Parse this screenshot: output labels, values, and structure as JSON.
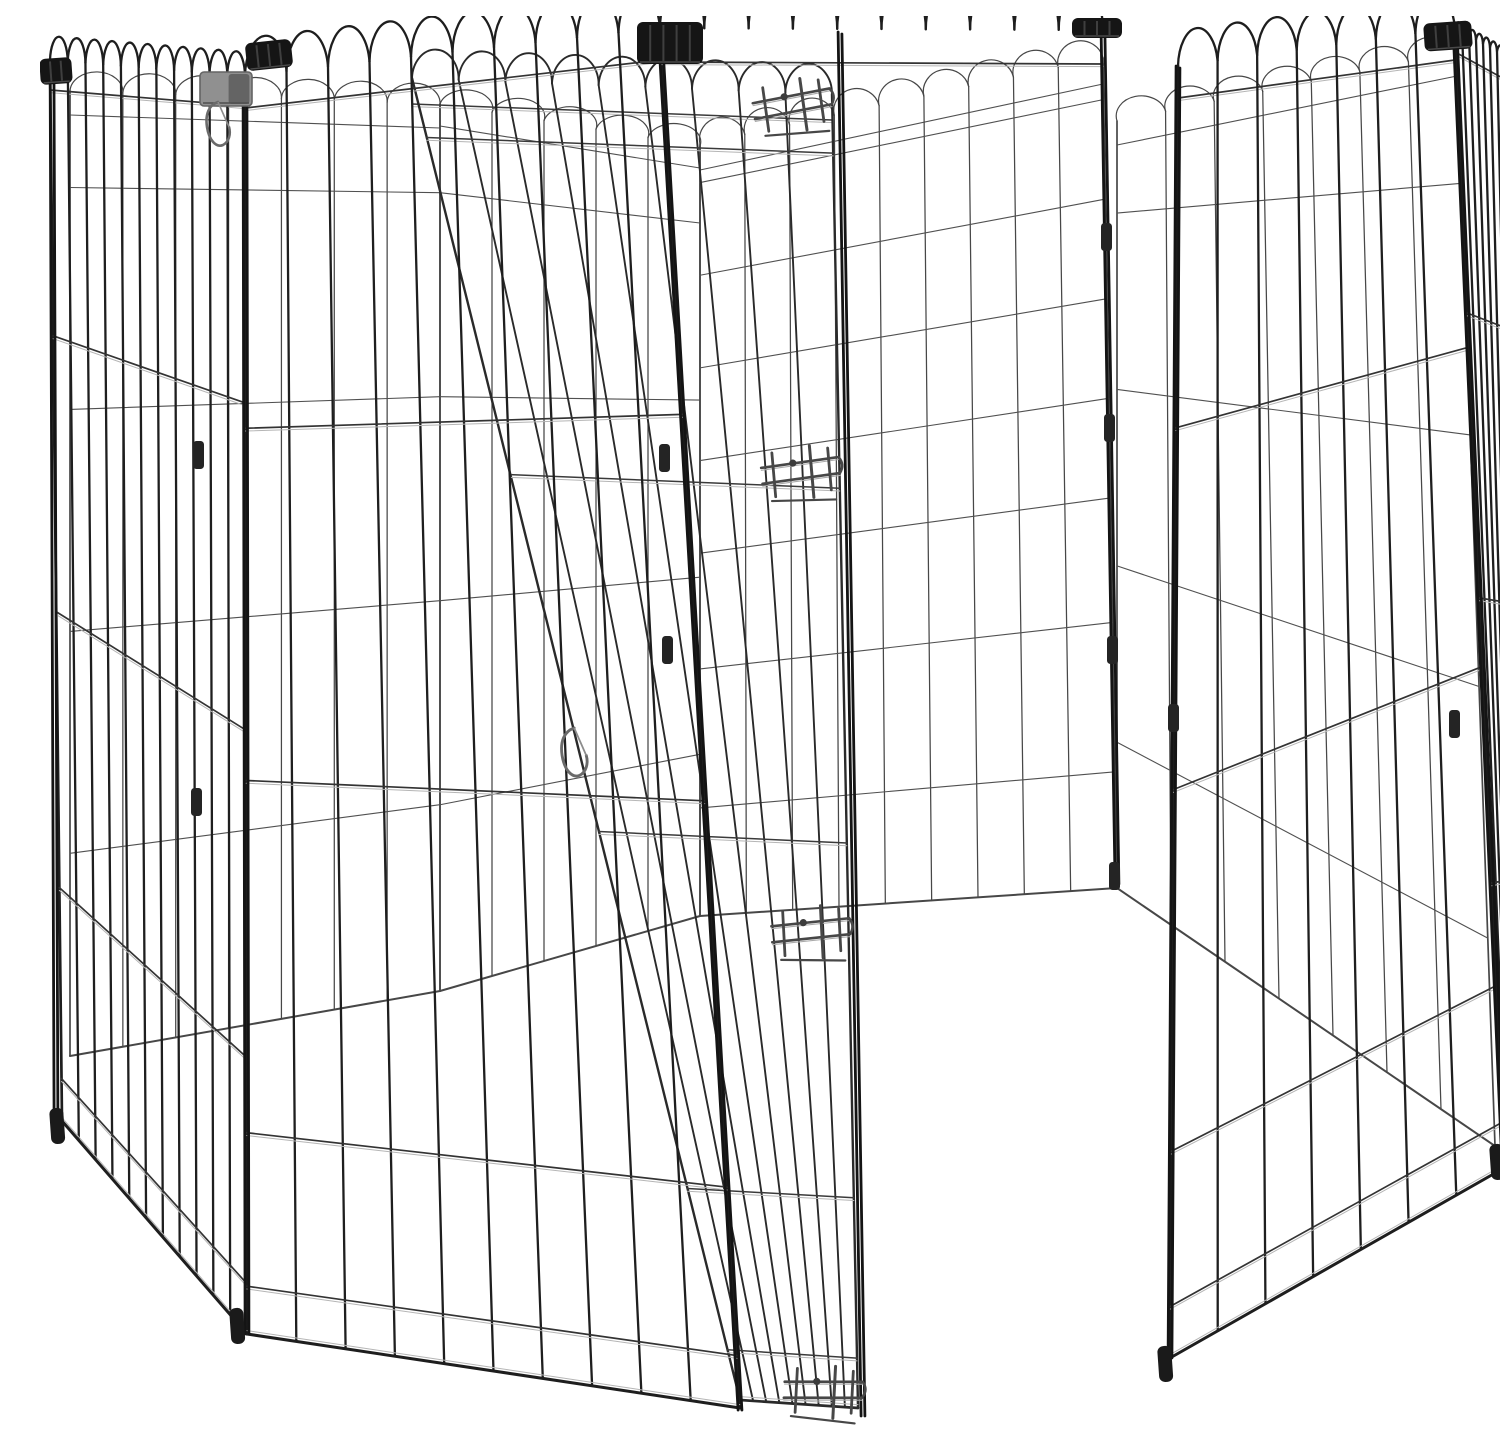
{
  "scene": {
    "label": "Octagonal black metal wire pet exercise pen with open walk-through door",
    "background": "#ffffff",
    "width": 1500,
    "height": 1412
  },
  "colors": {
    "wire_front": "#1e1e1e",
    "wire_front_h": "#333333",
    "wire_mid": "#2a2a2a",
    "wire_mid_h": "#3a3a3a",
    "wire_back": "#474747",
    "wire_back_h": "#505050",
    "wire_highlight": "#b5b5b5",
    "post": "#141414",
    "clip_black": "#151515",
    "clip_rib": "#3f3f3f",
    "clip_grey": "#909090",
    "clip_grey_dark": "#646464",
    "metal": "#474747",
    "metal_highlight": "#aaaaaa",
    "foot": "#1a1a1a"
  },
  "strokes": {
    "front_v": 2.3,
    "front_h": 1.7,
    "front_loop": 2.3,
    "front_edge": 2.7,
    "mid_v": 1.9,
    "mid_h": 1.5,
    "mid_loop": 1.9,
    "mid_edge": 2.4,
    "back_v": 1.25,
    "back_h": 1.1,
    "back_loop": 1.2,
    "back_edge": 1.7,
    "highlight": 1.0,
    "post": 2.8
  },
  "panels": [
    {
      "name": "panel-back-left-far",
      "layer": "back",
      "quad": [
        [
          30,
          75
        ],
        [
          400,
          88
        ],
        [
          400,
          975
        ],
        [
          30,
          1040
        ]
      ],
      "nV": 8,
      "loopH": 20,
      "topRail": 24,
      "hFracs": [
        0.1,
        0.33,
        0.56,
        0.79
      ],
      "bottom": true
    },
    {
      "name": "panel-back-center-far",
      "layer": "back",
      "quad": [
        [
          400,
          88
        ],
        [
          660,
          130
        ],
        [
          660,
          900
        ],
        [
          400,
          975
        ]
      ],
      "nV": 6,
      "loopH": 18,
      "topRail": 22,
      "hFracs": [
        0.1,
        0.33,
        0.56,
        0.79
      ],
      "bottom": true
    },
    {
      "name": "panel-back-right-inner",
      "layer": "back",
      "quad": [
        [
          660,
          128
        ],
        [
          1063,
          42
        ],
        [
          1077,
          872
        ],
        [
          660,
          900
        ]
      ],
      "nV": 10,
      "loopH": 22,
      "topRail": 26,
      "hFracs": [
        0.05,
        0.17,
        0.29,
        0.41,
        0.53,
        0.68,
        0.86
      ],
      "bottom": true
    },
    {
      "name": "panel-back-right-side",
      "layer": "back",
      "quad": [
        [
          1077,
          105
        ],
        [
          1417,
          36
        ],
        [
          1455,
          1130
        ],
        [
          1077,
          872
        ]
      ],
      "nV": 8,
      "loopH": 20,
      "topRail": 24,
      "hFracs": [
        0.12,
        0.35,
        0.58,
        0.81
      ],
      "bottom": true
    },
    {
      "name": "panel-door-open",
      "layer": "mid",
      "quad": [
        [
          372,
          62
        ],
        [
          792,
          78
        ],
        [
          818,
          1392
        ],
        [
          700,
          1384
        ]
      ],
      "nV": 10,
      "loopH": 30,
      "topRail": 26,
      "hFracs": [
        0.045,
        0.3,
        0.57,
        0.84,
        0.962
      ],
      "bottom": true
    },
    {
      "name": "panel-side-left",
      "layer": "front",
      "quad": [
        [
          10,
          44
        ],
        [
          205,
          60
        ],
        [
          207,
          1318
        ],
        [
          22,
          1105
        ]
      ],
      "nV": 12,
      "loopH": 26,
      "topRail": 30,
      "hFracs": [
        0.26,
        0.52,
        0.78,
        0.96
      ],
      "bottom": true
    },
    {
      "name": "panel-front-left",
      "layer": "front",
      "quad": [
        [
          205,
          60
        ],
        [
          620,
          12
        ],
        [
          700,
          1392
        ],
        [
          207,
          1318
        ]
      ],
      "nV": 11,
      "loopH": 42,
      "topRail": 32,
      "hFracs": [
        0.28,
        0.56,
        0.84,
        0.962
      ],
      "bottom": true
    },
    {
      "name": "top-rim-doorway",
      "layer": "front",
      "quad": [
        [
          620,
          12
        ],
        [
          1063,
          14
        ],
        [
          1063,
          14
        ],
        [
          620,
          12
        ]
      ],
      "nV": 11,
      "loopH": 44,
      "topRail": 34,
      "hFracs": [],
      "bottom": false,
      "loopsOnly": true
    },
    {
      "name": "panel-front-right",
      "layer": "front",
      "quad": [
        [
          1138,
          50
        ],
        [
          1415,
          12
        ],
        [
          1464,
          1152
        ],
        [
          1130,
          1342
        ]
      ],
      "nV": 8,
      "loopH": 40,
      "topRail": 32,
      "hFracs": [
        0.28,
        0.56,
        0.84,
        0.96
      ],
      "bottom": true
    },
    {
      "name": "panel-side-right",
      "layer": "front",
      "quad": [
        [
          1415,
          12
        ],
        [
          1499,
          58
        ],
        [
          1499,
          1125
        ],
        [
          1464,
          1152
        ]
      ],
      "nV": 13,
      "loopH": 14,
      "topRail": 24,
      "hFracs": [
        0.25,
        0.5,
        0.75,
        0.96
      ],
      "bottom": true
    }
  ],
  "posts": [
    {
      "name": "post-left-corner",
      "x1": 12,
      "y1": 44,
      "x2": 16,
      "y2": 1102
    },
    {
      "name": "post-front-left",
      "x1": 205,
      "y1": 60,
      "x2": 207,
      "y2": 1318
    },
    {
      "name": "post-door-left",
      "x1": 620,
      "y1": 12,
      "x2": 700,
      "y2": 1394
    },
    {
      "name": "post-door-hinge",
      "x1": 800,
      "y1": 16,
      "x2": 823,
      "y2": 1400
    },
    {
      "name": "post-doorway-right",
      "x1": 1063,
      "y1": 15,
      "x2": 1077,
      "y2": 868
    },
    {
      "name": "post-front-right",
      "x1": 1138,
      "y1": 50,
      "x2": 1130,
      "y2": 1342
    },
    {
      "name": "post-right-corner",
      "x1": 1415,
      "y1": 12,
      "x2": 1464,
      "y2": 1152
    }
  ],
  "clips_black": [
    {
      "name": "corner-clip",
      "x": 0,
      "y": 42,
      "w": 32,
      "h": 26,
      "r": -4
    },
    {
      "name": "corner-clip",
      "x": 206,
      "y": 25,
      "w": 46,
      "h": 28,
      "r": -6
    },
    {
      "name": "corner-clip",
      "x": 597,
      "y": 6,
      "w": 66,
      "h": 42,
      "r": 0
    },
    {
      "name": "corner-clip",
      "x": 1032,
      "y": 2,
      "w": 50,
      "h": 20,
      "r": 0
    },
    {
      "name": "corner-clip",
      "x": 1384,
      "y": 6,
      "w": 48,
      "h": 28,
      "r": -4
    },
    {
      "name": "corner-clip",
      "x": 1468,
      "y": 26,
      "w": 32,
      "h": 30,
      "r": 8
    }
  ],
  "clips_grey": [
    {
      "name": "hinge-clip",
      "x": 160,
      "y": 56,
      "w": 52,
      "h": 34
    }
  ],
  "clips_small": [
    {
      "x": 158,
      "y": 425
    },
    {
      "x": 156,
      "y": 772
    },
    {
      "x": 624,
      "y": 428
    },
    {
      "x": 627,
      "y": 620
    },
    {
      "x": 1066,
      "y": 207
    },
    {
      "x": 1069,
      "y": 398
    },
    {
      "x": 1072,
      "y": 620
    },
    {
      "x": 1074,
      "y": 846
    },
    {
      "x": 1133,
      "y": 688
    },
    {
      "x": 1414,
      "y": 694
    },
    {
      "x": 1477,
      "y": 828
    }
  ],
  "feet": [
    {
      "x": 16,
      "y": 1092
    },
    {
      "x": 196,
      "y": 1292
    },
    {
      "x": 1124,
      "y": 1330
    },
    {
      "x": 1456,
      "y": 1128
    }
  ],
  "carabiners": [
    {
      "x": 176,
      "y": 86,
      "s": 1.0
    },
    {
      "x": 532,
      "y": 712,
      "s": 1.1
    },
    {
      "x": 1482,
      "y": 52,
      "s": 1.0
    }
  ],
  "latches": [
    {
      "name": "door-latch-top",
      "cx": 758,
      "cy": 93,
      "r": -8
    },
    {
      "name": "door-latch-middle",
      "cx": 766,
      "cy": 460,
      "r": -5
    },
    {
      "name": "door-latch-lower",
      "cx": 776,
      "cy": 920,
      "r": -3
    },
    {
      "name": "door-latch-bottom",
      "cx": 788,
      "cy": 1380,
      "r": 3
    }
  ]
}
